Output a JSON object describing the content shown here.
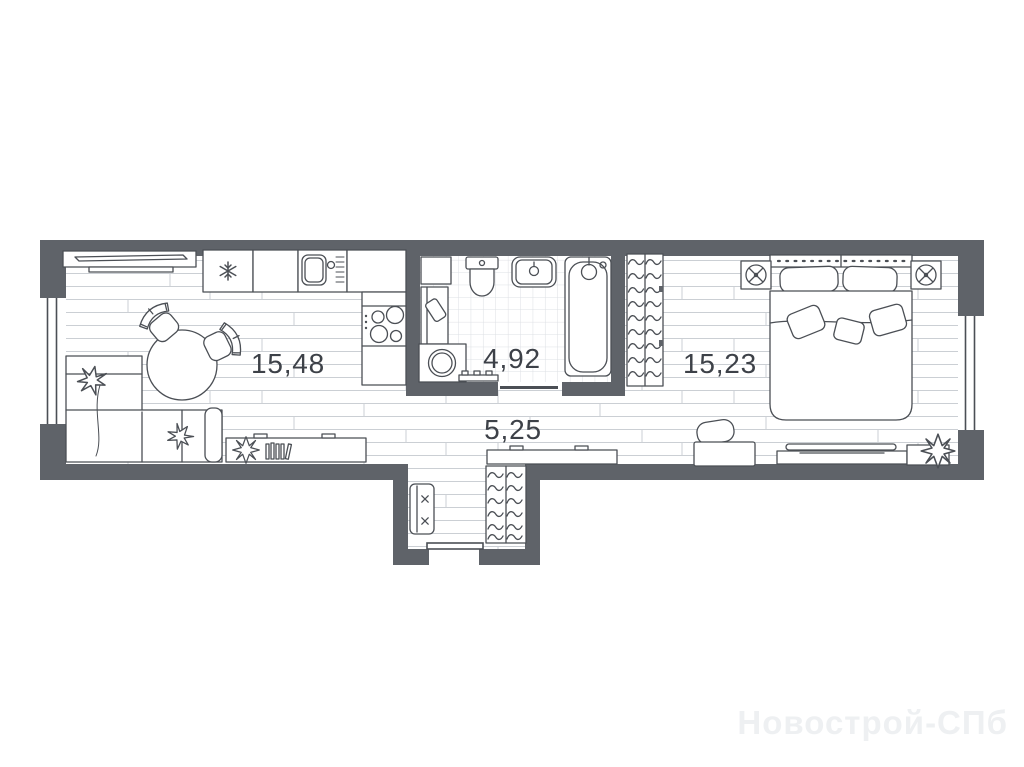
{
  "plan": {
    "type": "apartment-floor-plan",
    "rooms": [
      {
        "id": "living-kitchen",
        "area_label": "15,48"
      },
      {
        "id": "bathroom",
        "area_label": "4,92"
      },
      {
        "id": "bedroom",
        "area_label": "15,23"
      },
      {
        "id": "hallway",
        "area_label": "5,25"
      }
    ],
    "icons": {
      "fridge": "snowflake",
      "nightstand_left": "lamp",
      "nightstand_right": "lamp"
    },
    "colors": {
      "wall": "#5f6369",
      "outline": "#4b4f55",
      "floor_line": "#cbcfd4",
      "tile_line": "#dde0e4",
      "label_text": "#3d4148"
    }
  },
  "watermark": {
    "text": "Новострой-СПб",
    "color": "#eef0f2"
  }
}
